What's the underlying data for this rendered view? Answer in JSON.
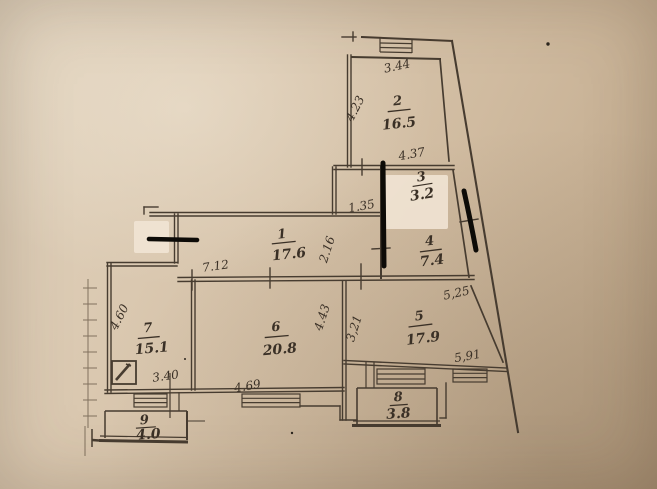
{
  "document": {
    "type": "apartment floor plan (scanned paper photo)",
    "paper_color": "#d5c1a8",
    "ink_color": "#473c30",
    "marker_color": "#0d0b07",
    "whiteout_color": "#f1e5d5"
  },
  "plan": {
    "rooms": [
      {
        "number": "1",
        "area": "17.6"
      },
      {
        "number": "2",
        "area": "16.5"
      },
      {
        "number": "3",
        "area": "3.2"
      },
      {
        "number": "4",
        "area": "7.4"
      },
      {
        "number": "5",
        "area": "17.9"
      },
      {
        "number": "6",
        "area": "20.8"
      },
      {
        "number": "7",
        "area": "15.1"
      },
      {
        "number": "8",
        "area": "3.8"
      },
      {
        "number": "9",
        "area": "4.0"
      }
    ],
    "dimensions": [
      {
        "label": "3.44"
      },
      {
        "label": "4.23"
      },
      {
        "label": "4.37"
      },
      {
        "label": "1.35"
      },
      {
        "label": "2.16"
      },
      {
        "label": "7.12"
      },
      {
        "label": "5,25"
      },
      {
        "label": "5,91"
      },
      {
        "label": "3,21"
      },
      {
        "label": "4.43"
      },
      {
        "label": "4.69"
      },
      {
        "label": "4.60"
      },
      {
        "label": "3.40"
      }
    ]
  }
}
